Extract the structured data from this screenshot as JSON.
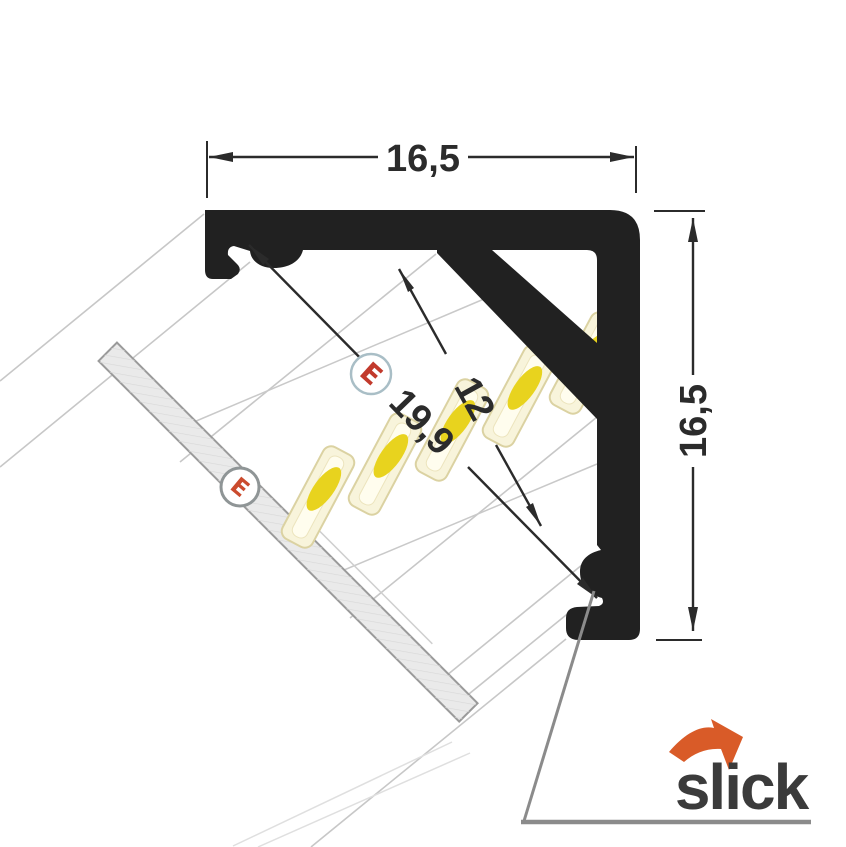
{
  "dimensions": {
    "width_top": "16,5",
    "height_right": "16,5",
    "strip_width": "12",
    "diagonal_opening": "19,9"
  },
  "markers": {
    "strip_marker": "E",
    "cover_marker": "E"
  },
  "brand": {
    "name": "slick"
  },
  "colors": {
    "profile_black": "#212121",
    "dimension_lines": "#2b2b2b",
    "led_body": "#f8f4db",
    "led_emitter_yellow": "#e8d31e",
    "marker_red": "#c23a2c",
    "brand_text": "#3b3b3b",
    "brand_arrow_orange": "#d95b28",
    "leader_gray": "#8b8b8b",
    "cover_gray": "#eaeaea",
    "perspective_gray": "#c7c7c7"
  }
}
